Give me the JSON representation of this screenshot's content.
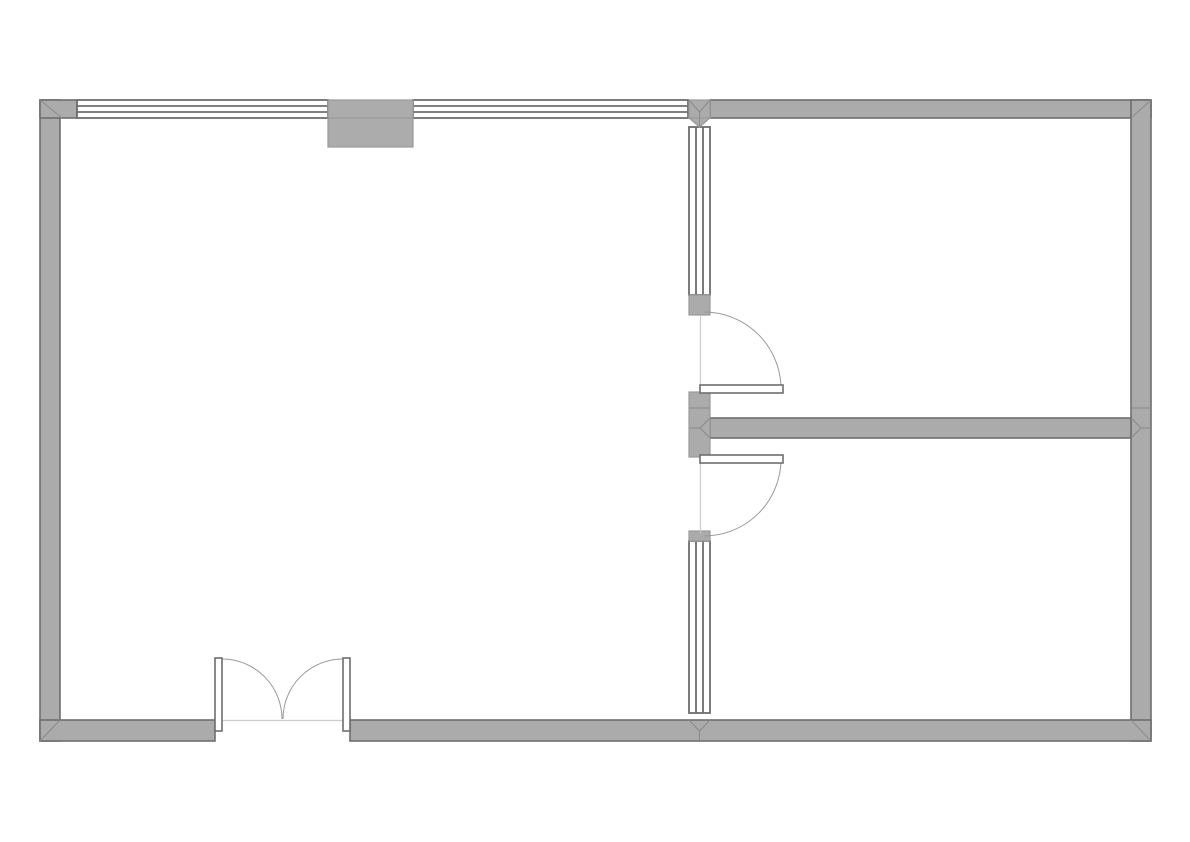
{
  "document": {
    "type": "floor-plan-drawing",
    "title": "",
    "visible_text": []
  },
  "colors": {
    "background": "#ffffff",
    "wall_fill": "#ababab",
    "wall_edge": "#6e6e6e",
    "block_fill": "#acacac",
    "block_edge": "#9a9a9a",
    "window_stroke": "#6e6e6e",
    "opening_line": "#cccccc",
    "arc_stroke": "#999999",
    "miter_line": "#8a8a8a"
  },
  "plan": {
    "rooms": [
      {
        "name": "large-left-room"
      },
      {
        "name": "upper-right-room"
      },
      {
        "name": "lower-right-room"
      }
    ],
    "elements": [
      {
        "name": "exterior-wall-left",
        "kind": "wall"
      },
      {
        "name": "exterior-wall-top",
        "kind": "wall"
      },
      {
        "name": "exterior-wall-right",
        "kind": "wall"
      },
      {
        "name": "exterior-wall-bottom",
        "kind": "wall"
      },
      {
        "name": "interior-wall-vertical",
        "kind": "wall"
      },
      {
        "name": "interior-wall-horizontal",
        "kind": "wall"
      },
      {
        "name": "top-window-left",
        "kind": "window"
      },
      {
        "name": "top-window-right",
        "kind": "window"
      },
      {
        "name": "vertical-window-upper",
        "kind": "window"
      },
      {
        "name": "vertical-window-lower",
        "kind": "window"
      },
      {
        "name": "chimney-block",
        "kind": "pillar"
      },
      {
        "name": "upper-interior-door",
        "kind": "single-door"
      },
      {
        "name": "lower-interior-door",
        "kind": "single-door"
      },
      {
        "name": "entrance-double-door",
        "kind": "double-door"
      }
    ]
  }
}
